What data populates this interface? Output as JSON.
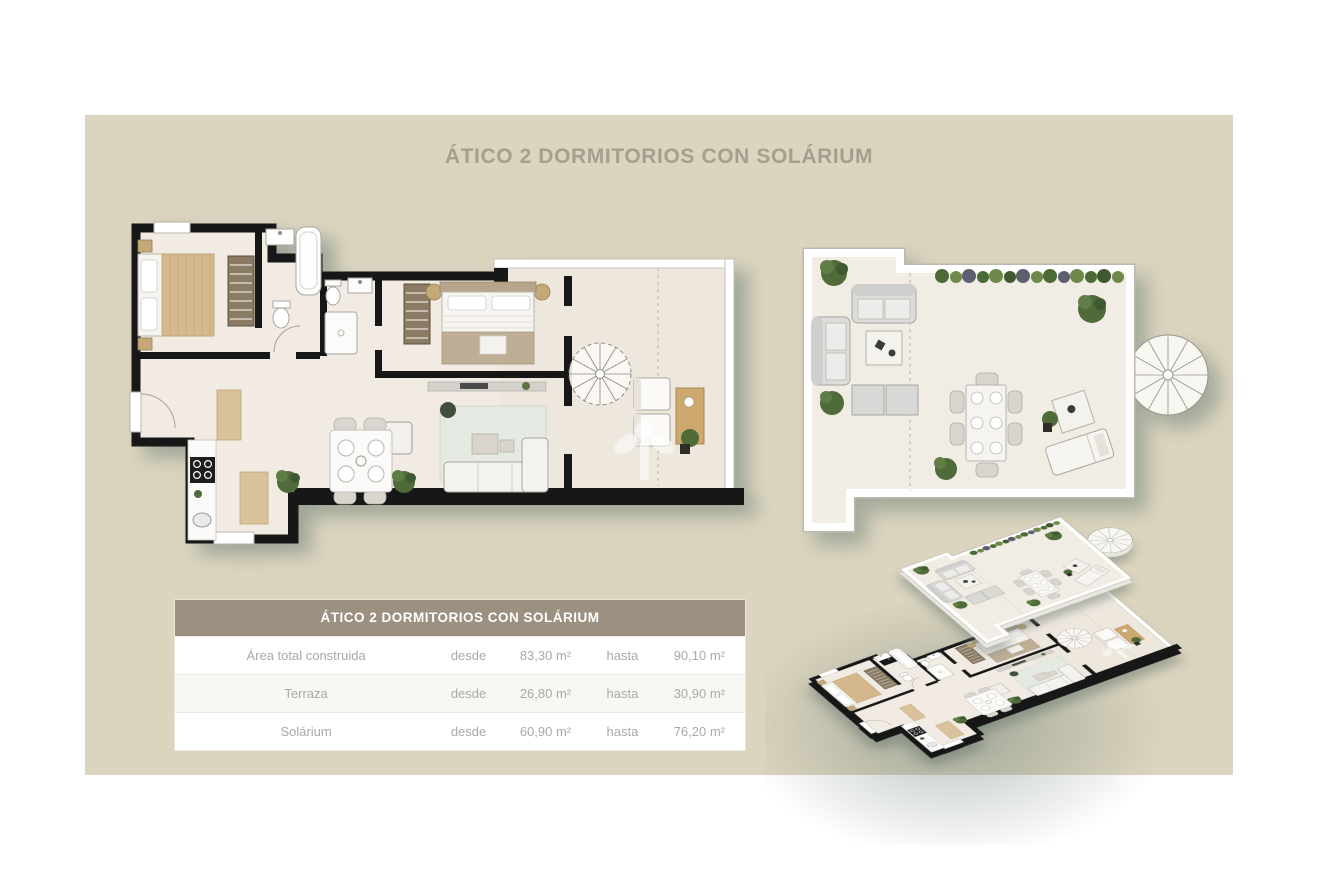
{
  "page": {
    "title": "ÁTICO 2 DORMITORIOS CON SOLÁRIUM"
  },
  "table": {
    "title": "ÁTICO 2 DORMITORIOS CON SOLÁRIUM",
    "rows": [
      {
        "label": "Área total construida",
        "desde": "desde",
        "from": "83,30 m²",
        "hasta": "hasta",
        "to": "90,10 m²"
      },
      {
        "label": "Terraza",
        "desde": "desde",
        "from": "26,80 m²",
        "hasta": "hasta",
        "to": "30,90 m²"
      },
      {
        "label": "Solárium",
        "desde": "desde",
        "from": "60,90 m²",
        "hasta": "hasta",
        "to": "76,20 m²"
      }
    ]
  },
  "colors": {
    "panel_bg": "#dbd4bf",
    "title_text": "#a79e8f",
    "table_header_bg": "#9c9080",
    "table_text": "#a9a9a9",
    "wall": "#171717",
    "floor": "#f1ebe3",
    "railing": "#ffffff",
    "wood": "#d8c29b",
    "plant_green": "#53703c",
    "shadow_green": "#6e8278"
  }
}
